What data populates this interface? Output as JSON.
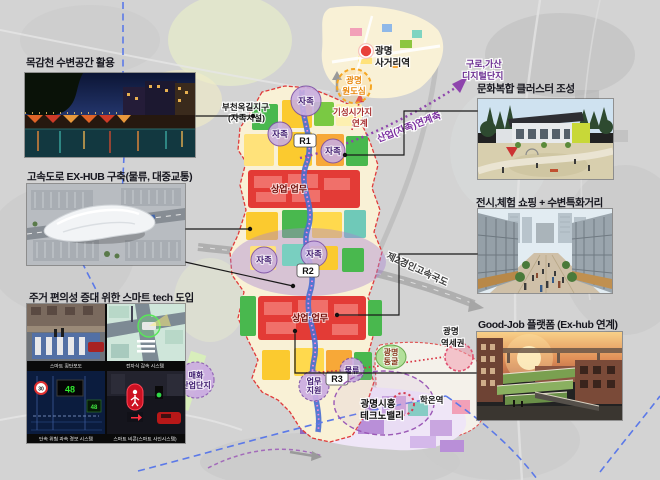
{
  "slide": {
    "callouts": {
      "waterfront": "목감천 수변공간 활용",
      "exhub": "고속도로 EX-HUB 구축(물류, 대중교통)",
      "smarttech": "주거 편의성 증대 위한 스마트 tech 도입",
      "culture": "문화복합 클러스터 조성",
      "exhibition": "전시,체험 쇼핑 + 수변특화거리",
      "goodjob": "Good-Job 플랫폼 (Ex-hub 연계)"
    }
  },
  "photos": {
    "smart": {
      "captions": [
        "스마트 횡단보도",
        "전자식 감속 시스템",
        "단속 위험 과속 경보 시스템",
        "스마트 비콘(스마트 사인시스템)"
      ],
      "sign_30": "30",
      "sign_48": "48"
    }
  },
  "map": {
    "station": {
      "l1": "광명",
      "l2": "사거리역"
    },
    "old_town": {
      "l1": "광명",
      "l2": "원도심"
    },
    "existing_link": {
      "l1": "기성시가지",
      "l2": "연계"
    },
    "digital": {
      "l1": "구로,가산",
      "l2": "디지털단지"
    },
    "bucheon": {
      "l1": "부천옥길지구",
      "l2": "(자족시설)"
    },
    "industry_axis": "산업(자족)연계축",
    "expressway": "제2경인고속국도",
    "jajok": "자족",
    "r1": "R1",
    "r2": "R2",
    "r3": "R3",
    "commerce": "상업·업무",
    "logistics": "물류",
    "biz_support": {
      "l1": "업무",
      "l2": "지원"
    },
    "maehwa": {
      "l1": "매화",
      "l2": "산업단지"
    },
    "cave": {
      "l1": "광명",
      "l2": "동굴"
    },
    "hakon": "학온역",
    "technovalley": {
      "l1": "광명시흥",
      "l2": "테크노밸리"
    },
    "station_area": {
      "l1": "광명",
      "l2": "역세권"
    }
  },
  "colors": {
    "zone_red": "#e33b36",
    "zone_green": "#49b84e",
    "zone_gold": "#fbca2f",
    "zone_lavender": "#c9aee0",
    "river_blue": "#4a6fd0",
    "boundary_red": "#e03a3a",
    "rail_blue": "#5b79e8",
    "axis_purple": "#8e44ad"
  }
}
